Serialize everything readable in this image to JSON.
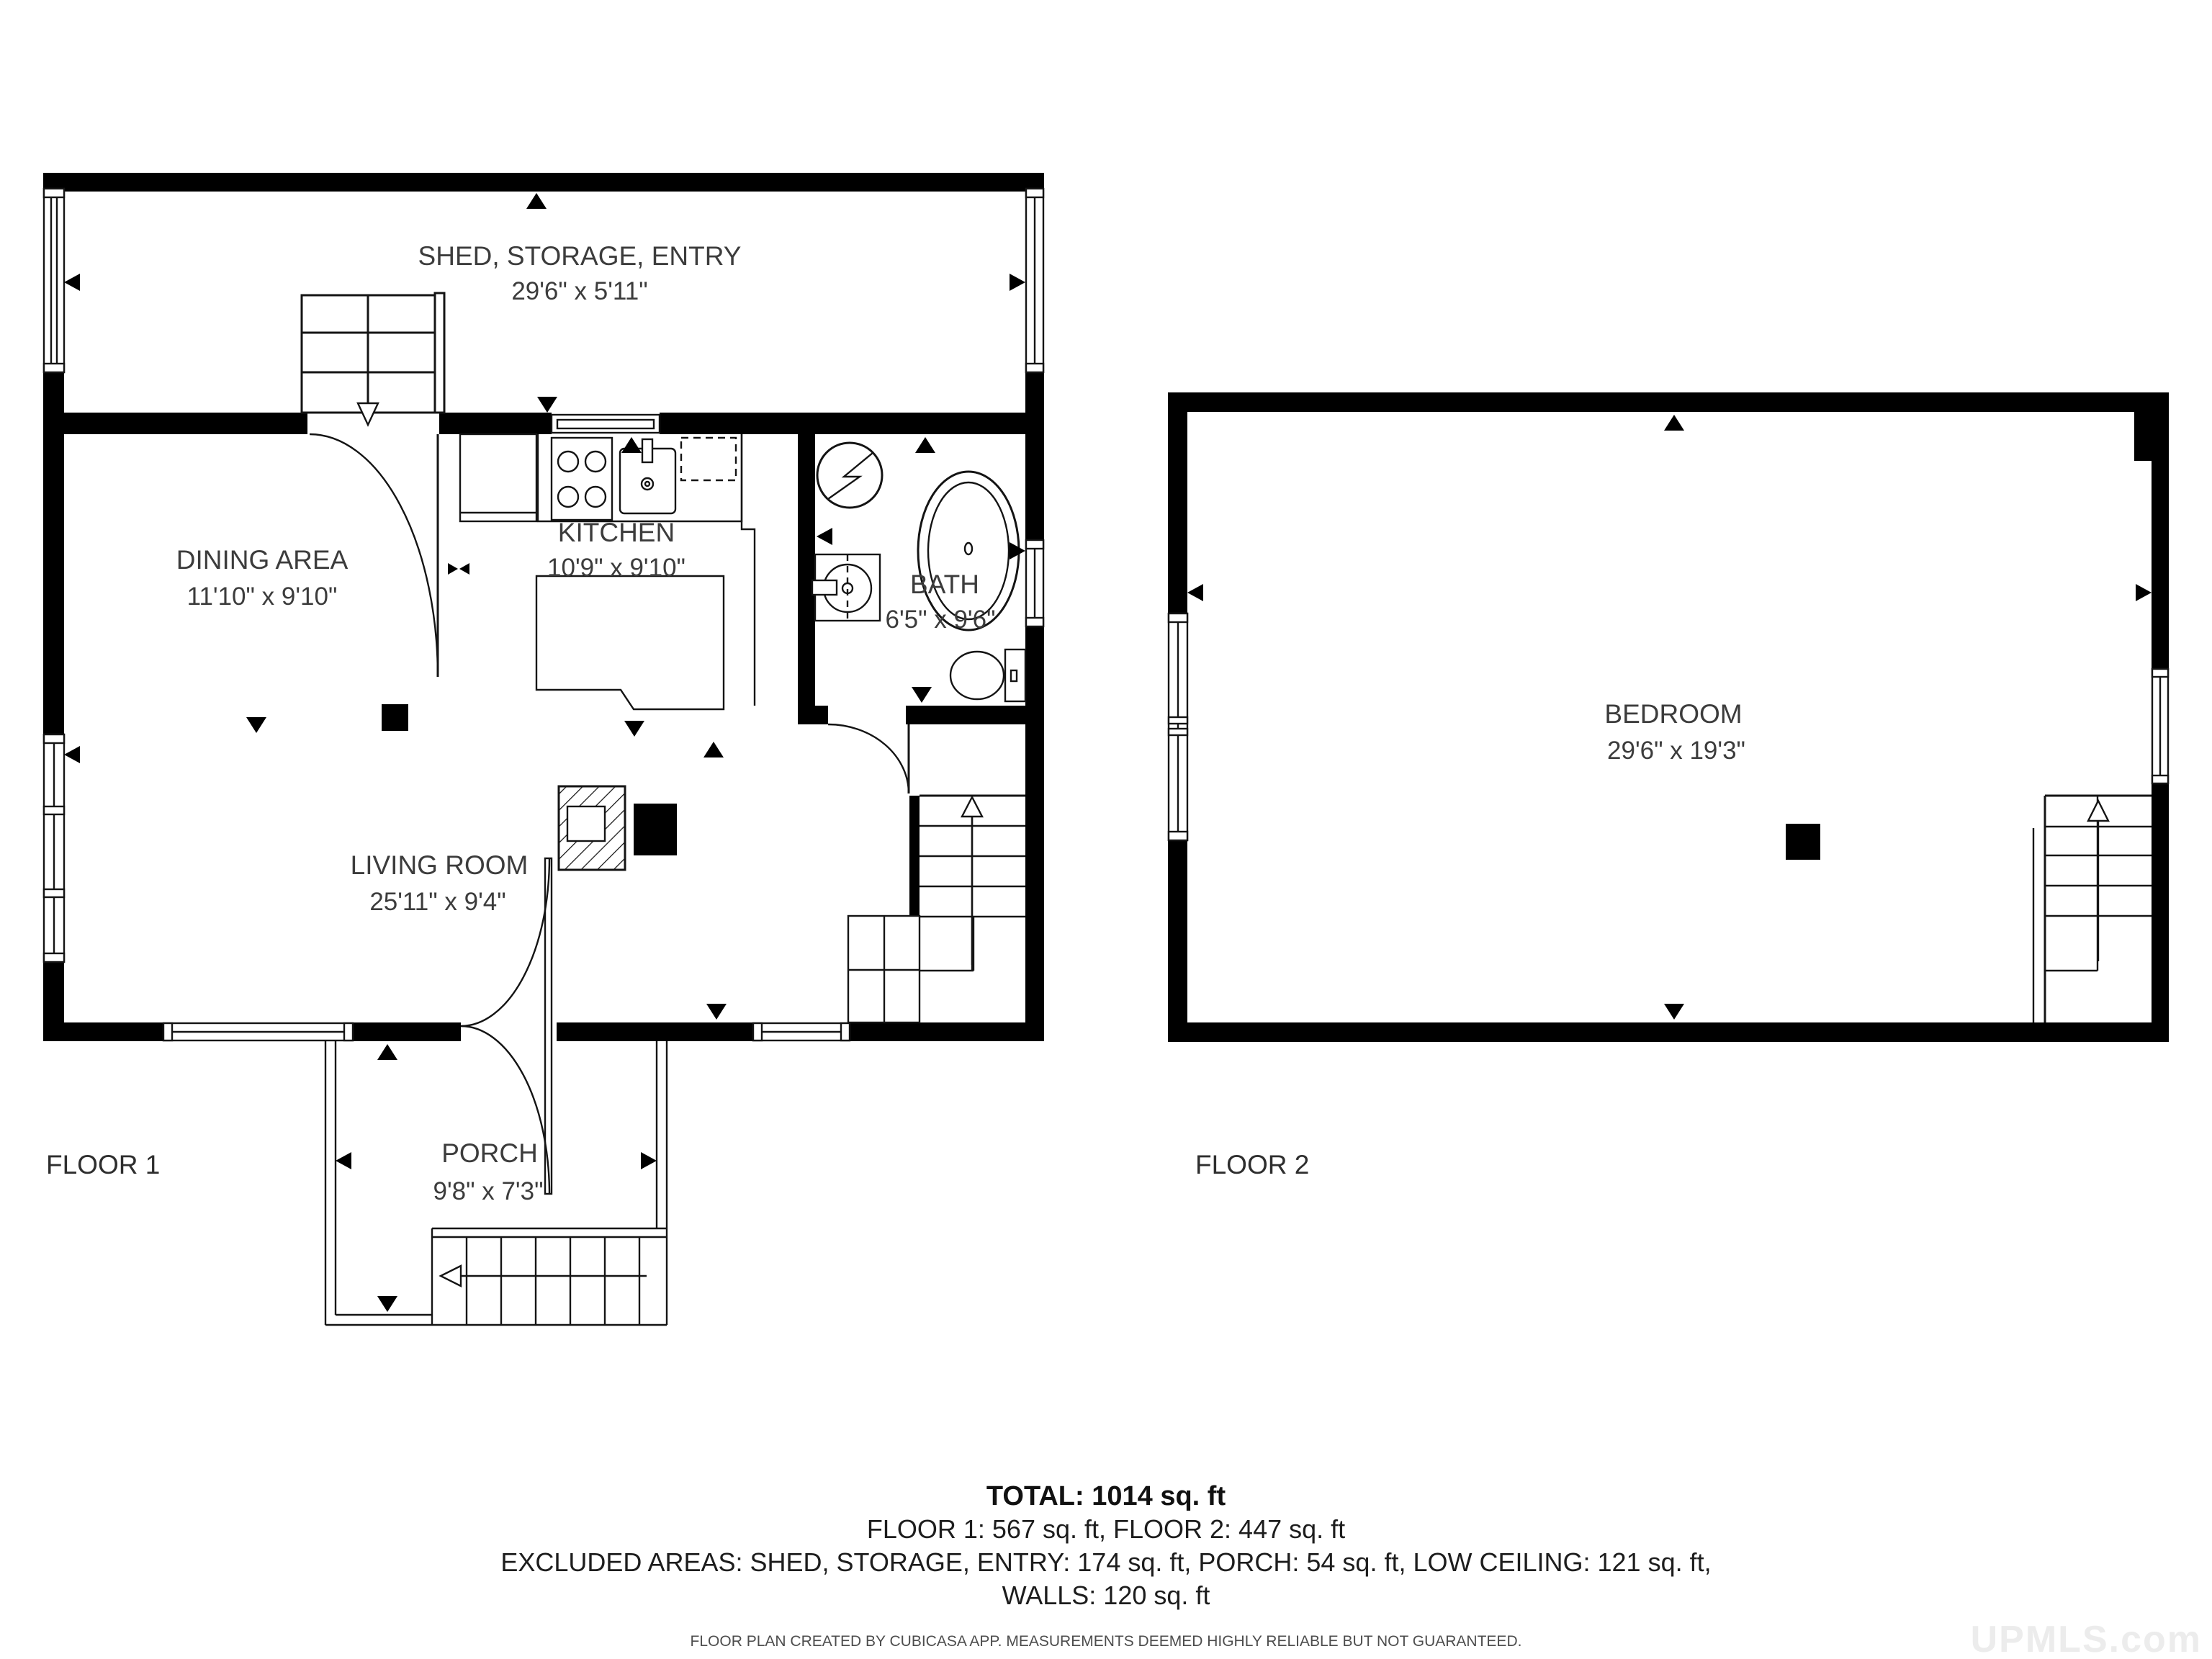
{
  "floor1": {
    "label": "FLOOR 1",
    "rooms": {
      "shed": {
        "name": "SHED, STORAGE, ENTRY",
        "dims": "29'6\" x 5'11\""
      },
      "kitchen": {
        "name": "KITCHEN",
        "dims": "10'9\" x 9'10\""
      },
      "dining": {
        "name": "DINING AREA",
        "dims": "11'10\" x 9'10\""
      },
      "bath": {
        "name": "BATH",
        "dims": "6'5\" x 9'6\""
      },
      "living": {
        "name": "LIVING ROOM",
        "dims": "25'11\" x 9'4\""
      },
      "porch": {
        "name": "PORCH",
        "dims": "9'8\" x 7'3\""
      }
    }
  },
  "floor2": {
    "label": "FLOOR 2",
    "rooms": {
      "bedroom": {
        "name": "BEDROOM",
        "dims": "29'6\" x 19'3\""
      }
    }
  },
  "summary": {
    "total": "TOTAL: 1014 sq. ft",
    "floors": "FLOOR 1: 567 sq. ft, FLOOR 2: 447 sq. ft",
    "excluded": "EXCLUDED AREAS: SHED, STORAGE, ENTRY: 174 sq. ft, PORCH: 54 sq. ft, LOW CEILING: 121 sq. ft,",
    "walls": "WALLS: 120 sq. ft"
  },
  "footer": {
    "disclaimer": "FLOOR PLAN CREATED BY CUBICASA APP. MEASUREMENTS DEEMED HIGHLY RELIABLE BUT NOT GUARANTEED."
  },
  "watermark": "UPMLS.com",
  "colors": {
    "wall": "#000000",
    "line": "#141414",
    "text": "#3c3c3c",
    "watermark": "#ececec"
  }
}
